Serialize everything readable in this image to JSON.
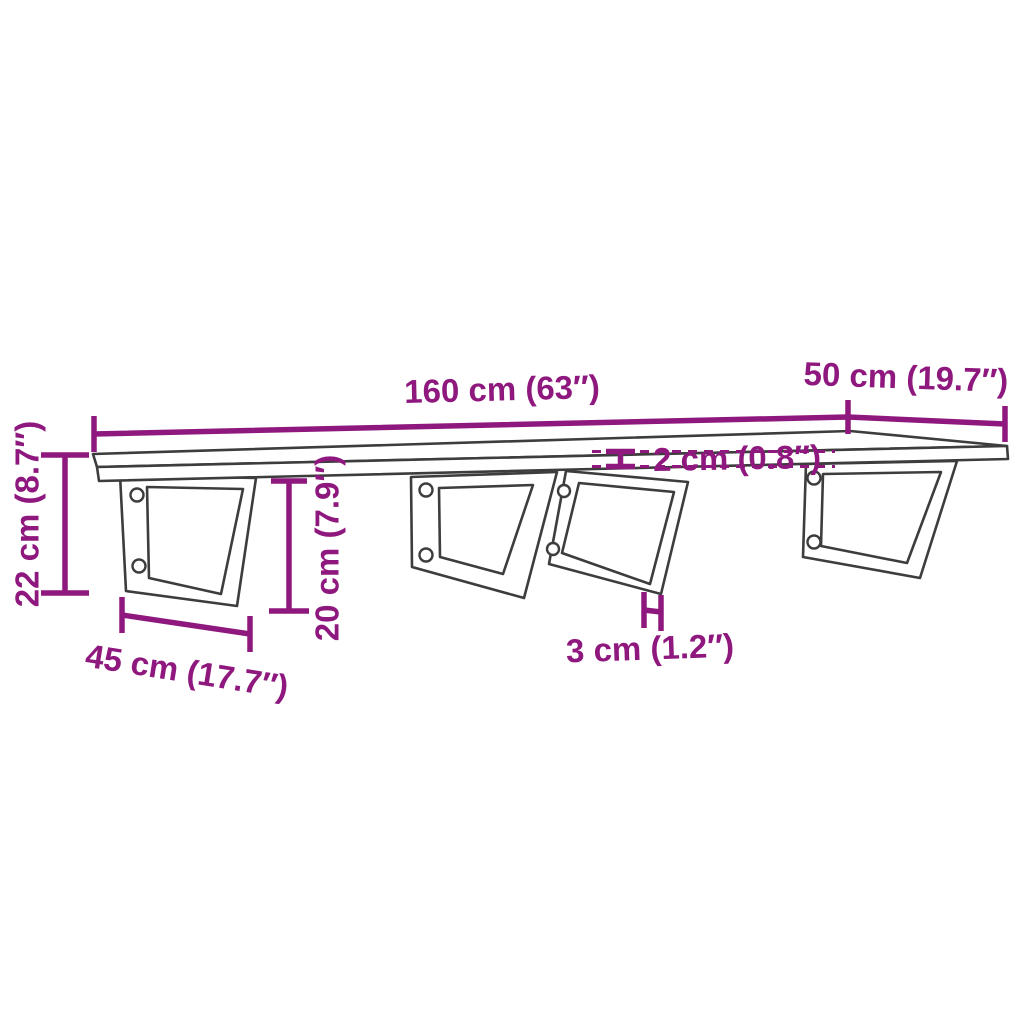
{
  "diagram": {
    "description": "Dimension drawing of a wall-mounted shelf board with four steel wall brackets",
    "colors": {
      "accent": "#8e187e",
      "outline": "#3d3d3d",
      "background": "#ffffff"
    },
    "dims": {
      "shelf_length": {
        "cm": 160,
        "inches": 63,
        "label": "160 cm (63″)"
      },
      "shelf_depth": {
        "cm": 50,
        "inches": 19.7,
        "label": "50 cm (19.7″)"
      },
      "shelf_thickness": {
        "cm": 2,
        "inches": 0.8,
        "label": "2 cm (0.8″)"
      },
      "bracket_height": {
        "cm": 22,
        "inches": 8.7,
        "label": "22 cm (8.7″)"
      },
      "bracket_depth": {
        "cm": 45,
        "inches": 17.7,
        "label": "45 cm (17.7″)"
      },
      "bracket_drop": {
        "cm": 20,
        "inches": 7.9,
        "label": "20 cm (7.9″)"
      },
      "bar_width": {
        "cm": 3,
        "inches": 1.2,
        "label": "3 cm (1.2″)"
      }
    }
  }
}
